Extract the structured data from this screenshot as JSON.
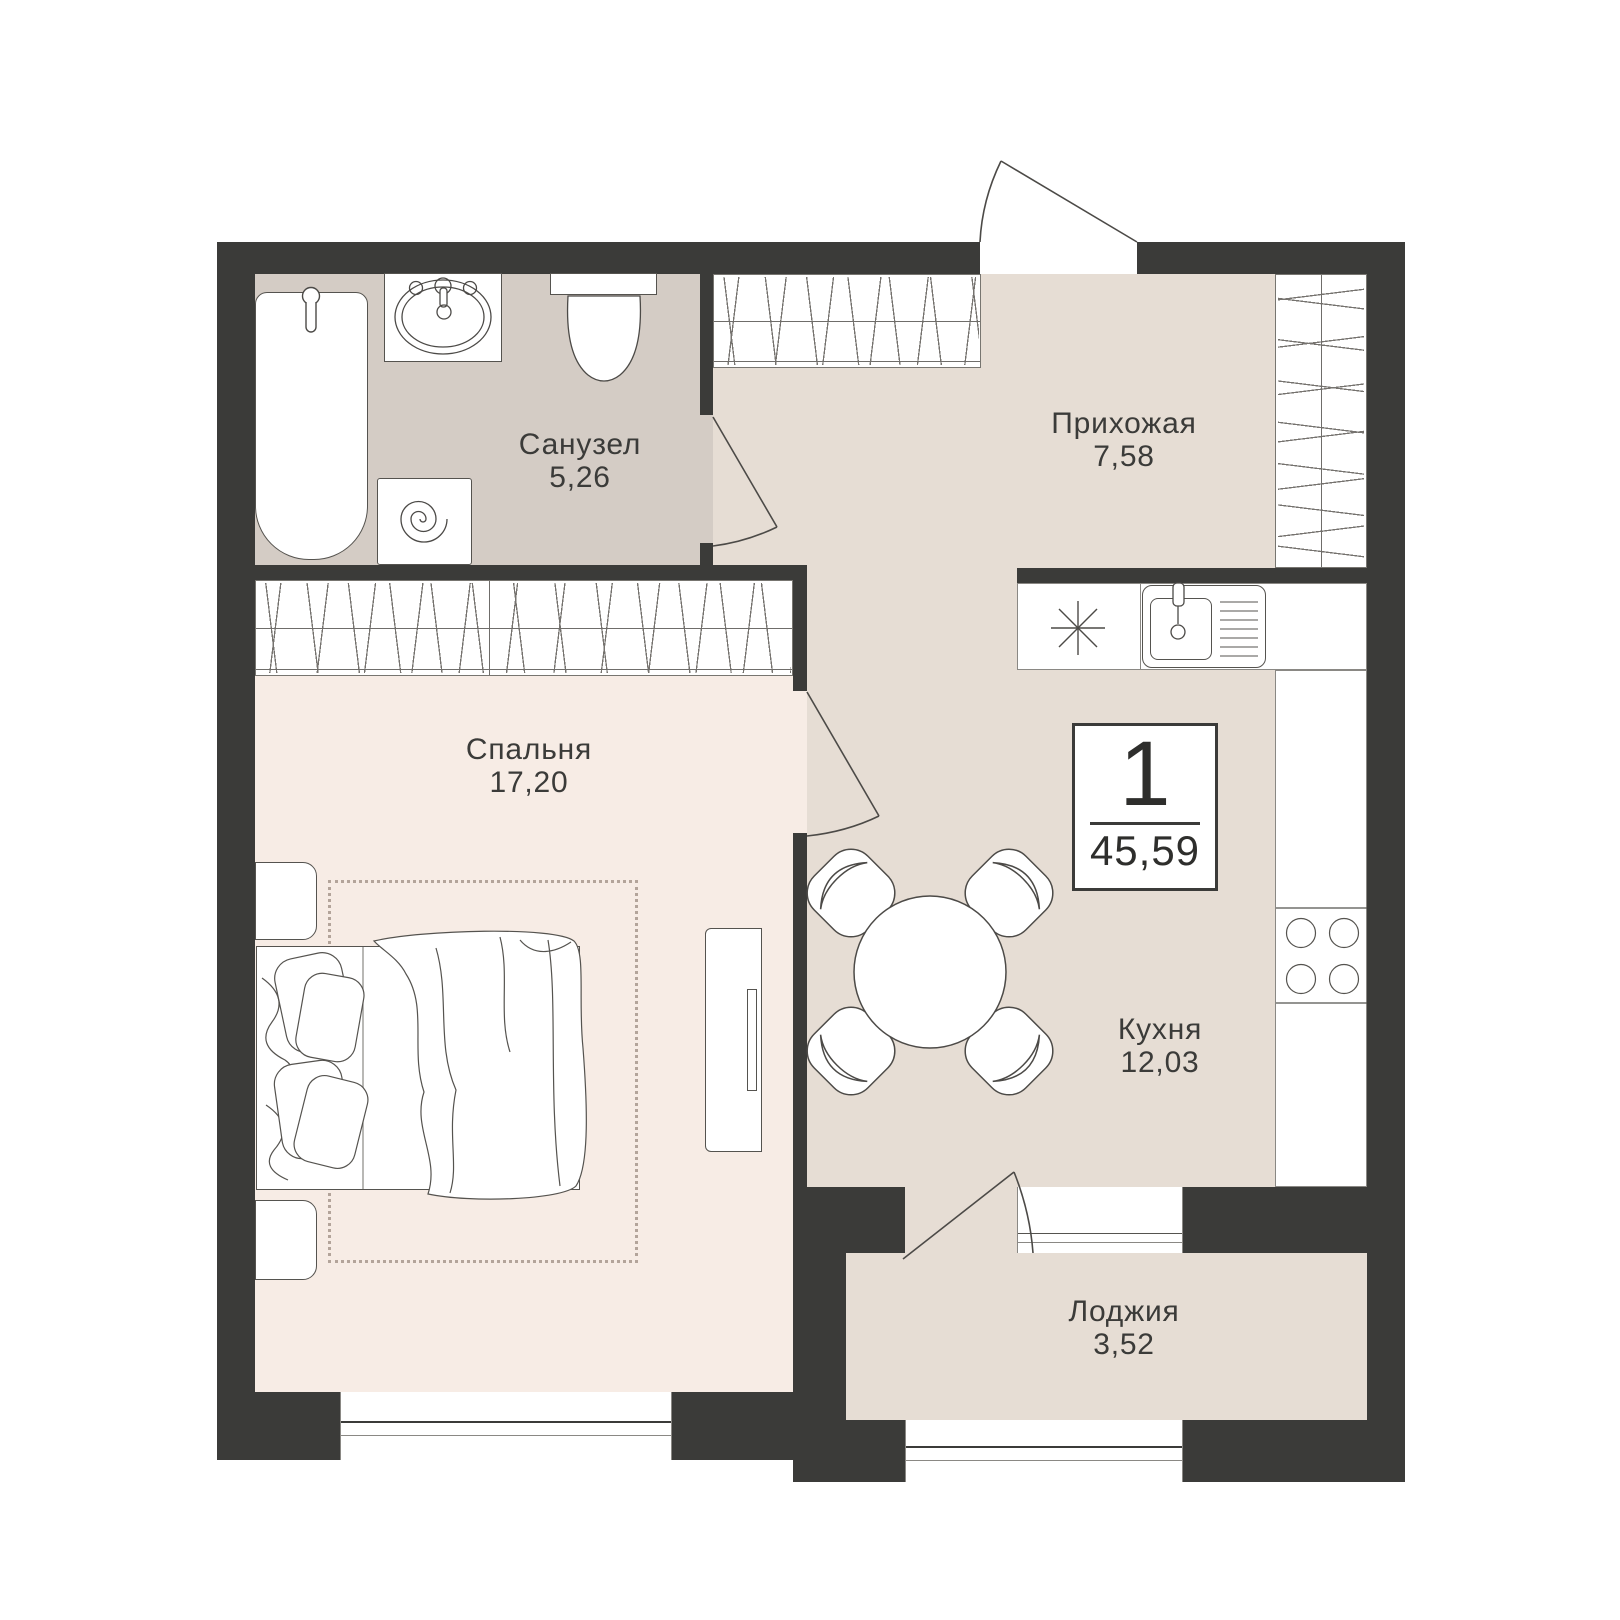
{
  "plan_type": "apartment-floor-plan",
  "rooms": [
    {
      "id": "bathroom",
      "name": "Санузел",
      "area": "5,26"
    },
    {
      "id": "hallway",
      "name": "Прихожая",
      "area": "7,58"
    },
    {
      "id": "bedroom",
      "name": "Спальня",
      "area": "17,20"
    },
    {
      "id": "kitchen",
      "name": "Кухня",
      "area": "12,03"
    },
    {
      "id": "loggia",
      "name": "Лоджия",
      "area": "3,52"
    }
  ],
  "summary": {
    "rooms_count": "1",
    "total_area": "45,59"
  },
  "colors": {
    "wall": "#3b3b39",
    "floor_beige": "#e6ddd4",
    "floor_gray": "#d4ccc5",
    "floor_pink": "#f7ece5",
    "outline": "#4c4a47",
    "rug_border": "#b3a49a"
  }
}
